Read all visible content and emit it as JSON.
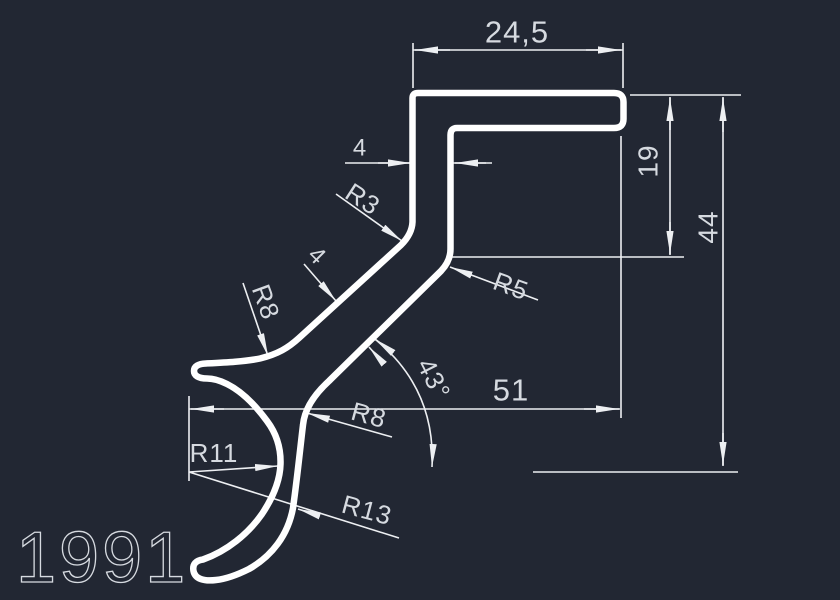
{
  "drawing": {
    "part_number": "1991",
    "labels": {
      "width_top": "24,5",
      "thickness_top": "4",
      "fillet_r3": "R3",
      "fillet_r5": "R5",
      "radius_r8_upper": "R8",
      "thickness_diagonal": "4",
      "angle": "43°",
      "length_51": "51",
      "height_19": "19",
      "height_44": "44",
      "radius_r8_lower": "R8",
      "radius_r11": "R11",
      "radius_r13": "R13"
    },
    "colors": {
      "background": "#222733",
      "profile_line": "#ffffff",
      "dimension_line": "#edeff2",
      "text": "#d6dae0"
    }
  }
}
